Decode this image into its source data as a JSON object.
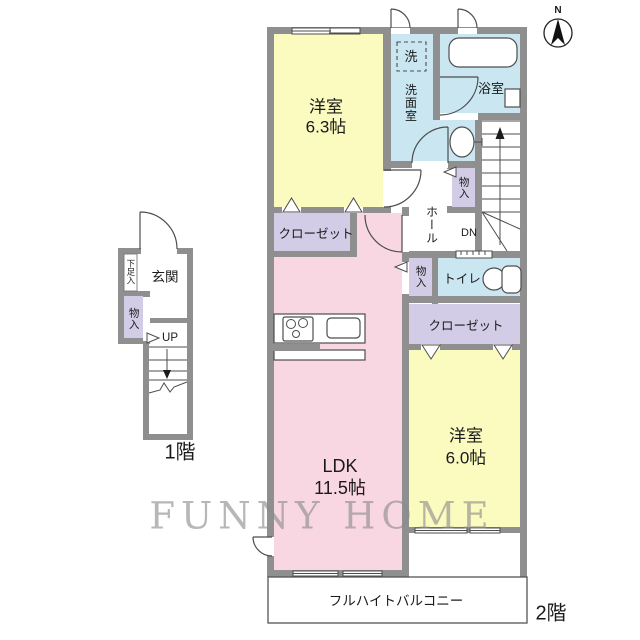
{
  "colors": {
    "wall": "#8f8f8f",
    "line": "#4d4d4d",
    "text": "#1a1a1a",
    "room-yellow": "#fbfabf",
    "room-pink": "#f8d7e3",
    "room-blue": "#c9e6f1",
    "room-lavender": "#d3cce6",
    "watermark": "#8c8c8c"
  },
  "watermark": "FUNNY HOME",
  "compass": {
    "north": "N"
  },
  "floor1": {
    "label": "1階",
    "entrance": "玄関",
    "shoe_cabinet": "下足入",
    "storage": "物入",
    "stairs_up": "UP"
  },
  "floor2": {
    "label": "2階",
    "bedroom_a_name": "洋室",
    "bedroom_a_size": "6.3帖",
    "washer": "洗",
    "washroom": "洗面室",
    "bathroom": "浴室",
    "hall": "ホール",
    "hall_storage": "物入",
    "stairs_down": "DN",
    "closet_a": "クローゼット",
    "ldk_storage": "物入",
    "toilet": "トイレ",
    "closet_b": "クローゼット",
    "ldk_name": "LDK",
    "ldk_size": "11.5帖",
    "bedroom_b_name": "洋室",
    "bedroom_b_size": "6.0帖",
    "balcony": "フルハイトバルコニー"
  }
}
